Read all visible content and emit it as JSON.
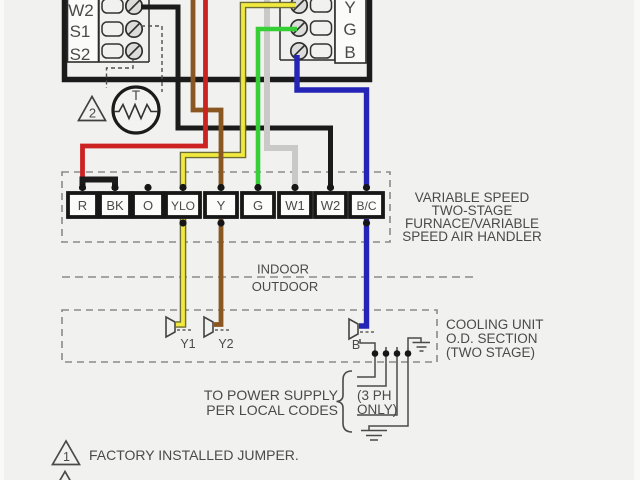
{
  "colors": {
    "bg": "#f1f1ef",
    "black": "#1b1b1b",
    "red": "#cd2222",
    "brown": "#8a5622",
    "yellow": "#f1e93e",
    "yellow_outline": "#6e6e35",
    "green": "#36cf36",
    "gray": "#c9c9c7",
    "blue": "#2424b6",
    "dash": "#8a8a8a",
    "line": "#4a4a4a",
    "text": "#4a4a4a",
    "terminal_text": "#2b2b2b"
  },
  "blocks": {
    "left": {
      "labels": [
        "W2",
        "S1",
        "S2"
      ]
    },
    "right": {
      "labels": [
        "Y",
        "G",
        "B"
      ]
    }
  },
  "sensor": {
    "label": "T",
    "note": "2"
  },
  "terminals": {
    "items": [
      "R",
      "BK",
      "O",
      "YLO",
      "Y",
      "G",
      "W1",
      "W2",
      "B/C"
    ]
  },
  "furnace": {
    "lines": [
      "VARIABLE SPEED",
      "TWO-STAGE",
      "FURNACE/VARIABLE",
      "SPEED AIR HANDLER"
    ]
  },
  "boundary": {
    "indoor": "INDOOR",
    "outdoor": "OUTDOOR"
  },
  "cooling": {
    "lines": [
      "COOLING UNIT",
      "O.D. SECTION",
      "(TWO STAGE)"
    ],
    "contactors": {
      "y1": "Y1",
      "y2": "Y2",
      "b": "B"
    }
  },
  "power": {
    "line1": "TO POWER SUPPLY",
    "line2": "PER LOCAL CODES",
    "phase1": "(3 PH",
    "phase2": "ONLY)"
  },
  "legend": {
    "note1_number": "1",
    "note1_text": "FACTORY INSTALLED JUMPER."
  }
}
